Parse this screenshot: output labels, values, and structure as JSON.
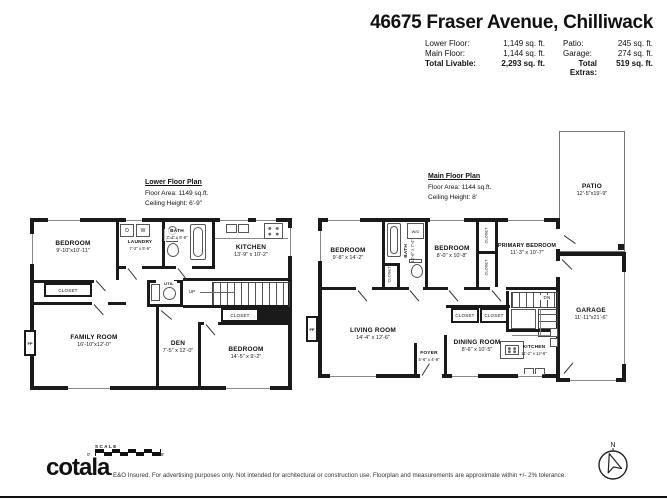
{
  "header": {
    "title": "46675 Fraser Avenue, Chilliwack",
    "stats": {
      "rows": [
        {
          "ll": "Lower Floor:",
          "lv": "1,149 sq. ft.",
          "rl": "Patio:",
          "rv": "245 sq. ft."
        },
        {
          "ll": "Main Floor:",
          "lv": "1,144 sq. ft.",
          "rl": "Garage:",
          "rv": "274 sq. ft."
        },
        {
          "ll": "Total Livable:",
          "lv": "2,293 sq. ft.",
          "rl": "Total Extras:",
          "rv": "519 sq. ft."
        }
      ]
    }
  },
  "lower": {
    "title": "Lower Floor Plan",
    "area": "Floor Area: 1149 sq.ft.",
    "ceiling": "Ceiling Height: 6'-9\"",
    "rooms": {
      "bedroom1": {
        "name": "BEDROOM",
        "dims": "9'-10\"x10'-11\""
      },
      "laundry": {
        "name": "LAUNDRY",
        "dims": "7'-2\" x 5'-6\""
      },
      "bath": {
        "name": "BATH",
        "dims": "7'-4\" x 5'-6\""
      },
      "kitchen": {
        "name": "KITCHEN",
        "dims": "13'-9\" x 10'-2\""
      },
      "util": {
        "name": "UTIL"
      },
      "family": {
        "name": "FAMILY ROOM",
        "dims": "16'-10\"x12'-0\""
      },
      "den": {
        "name": "DEN",
        "dims": "7'-5\" x 12'-0\""
      },
      "bedroom2": {
        "name": "BEDROOM",
        "dims": "14'-5\" x 9'-2\""
      }
    },
    "labels": {
      "closet_a": "CLOSET",
      "closet_b": "CLOSET",
      "up": "UP",
      "dryer": "D",
      "washer": "W",
      "fp": "FP"
    }
  },
  "main": {
    "title": "Main Floor Plan",
    "area": "Floor Area: 1144 sq.ft.",
    "ceiling": "Ceiling Height: 8'",
    "rooms": {
      "bedroom1": {
        "name": "BEDROOM",
        "dims": "9'-8\" x 14'-2\""
      },
      "bath": {
        "name": "BATH",
        "dims": "10'-6\" x 7'-4\""
      },
      "bedroom2": {
        "name": "BEDROOM",
        "dims": "8'-0\" x 10'-8\""
      },
      "primary": {
        "name": "PRIMARY BEDROOM",
        "dims": "11'-3\" x 10'-7\""
      },
      "living": {
        "name": "LIVING ROOM",
        "dims": "14'-4\" x 12'-6\""
      },
      "foyer": {
        "name": "FOYER",
        "dims": "5'-6\" x 4'-8\""
      },
      "dining": {
        "name": "DINING ROOM",
        "dims": "8'-6\" x 10'-5\""
      },
      "kitchen": {
        "name": "KITCHEN",
        "dims": "11'-2\" x 12'-6\""
      },
      "patio": {
        "name": "PATIO",
        "dims": "12'-5\"x19'-9\""
      },
      "garage": {
        "name": "GARAGE",
        "dims": "11'-11\"x21'-6\""
      }
    },
    "labels": {
      "closet_a": "CLOSET",
      "closet_b": "CLOSET",
      "closet_c": "CLOSET",
      "closet_d": "CLOSET",
      "closet_e": "CLOSET",
      "dn": "DN",
      "wd": "W/D",
      "fp": "FP"
    }
  },
  "footer": {
    "scale_label": "SCALE",
    "scale_start": "0'",
    "scale_end": "8'",
    "brand": "cotala",
    "brand_mark": ".",
    "disclaimer": "E&O Insured. For advertising purposes only. Not intended for architectural or construction use. Floorplan and measurements are approximate within +/- 2% tolerance.",
    "compass_n": "N"
  }
}
